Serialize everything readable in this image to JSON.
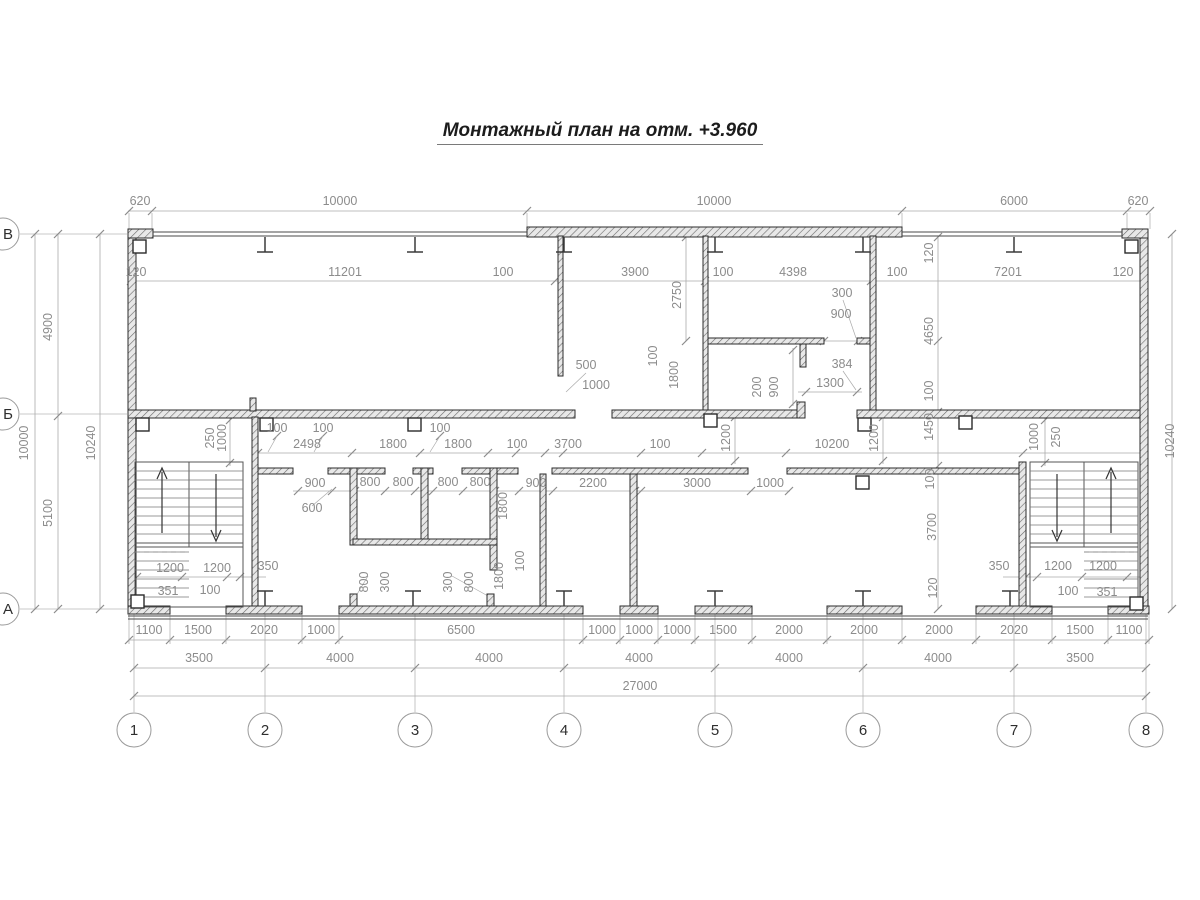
{
  "title": "Монтажный план на отм. +3.960",
  "colors": {
    "wall_line": "#2b2b2b",
    "dim_text": "#8c8c8c",
    "dim_line": "#aaaaaa",
    "grid_line": "#b8b8b8",
    "background": "#ffffff"
  },
  "axes": {
    "rows": [
      {
        "label": "В",
        "y": 234
      },
      {
        "label": "Б",
        "y": 414
      },
      {
        "label": "А",
        "y": 609
      }
    ],
    "cols": [
      {
        "label": "1",
        "x": 134
      },
      {
        "label": "2",
        "x": 265
      },
      {
        "label": "3",
        "x": 415
      },
      {
        "label": "4",
        "x": 564
      },
      {
        "label": "5",
        "x": 715
      },
      {
        "label": "6",
        "x": 863
      },
      {
        "label": "7",
        "x": 1014
      },
      {
        "label": "8",
        "x": 1146
      }
    ]
  },
  "dims": [
    {
      "t": "620",
      "x": 140,
      "y": 205
    },
    {
      "t": "10000",
      "x": 340,
      "y": 205
    },
    {
      "t": "10000",
      "x": 714,
      "y": 205
    },
    {
      "t": "6000",
      "x": 1014,
      "y": 205
    },
    {
      "t": "620",
      "x": 1138,
      "y": 205
    },
    {
      "t": "120",
      "x": 136,
      "y": 276
    },
    {
      "t": "11201",
      "x": 345,
      "y": 276
    },
    {
      "t": "100",
      "x": 503,
      "y": 276
    },
    {
      "t": "3900",
      "x": 635,
      "y": 276
    },
    {
      "t": "100",
      "x": 723,
      "y": 276
    },
    {
      "t": "4398",
      "x": 793,
      "y": 276
    },
    {
      "t": "100",
      "x": 897,
      "y": 276
    },
    {
      "t": "7201",
      "x": 1008,
      "y": 276
    },
    {
      "t": "120",
      "x": 1123,
      "y": 276
    },
    {
      "t": "4900",
      "x": 52,
      "y": 327,
      "r": -90
    },
    {
      "t": "5100",
      "x": 52,
      "y": 513,
      "r": -90
    },
    {
      "t": "10000",
      "x": 28,
      "y": 443,
      "r": -90
    },
    {
      "t": "10240",
      "x": 95,
      "y": 443,
      "r": -90
    },
    {
      "t": "10240",
      "x": 1174,
      "y": 441,
      "r": -90
    },
    {
      "t": "120",
      "x": 933,
      "y": 253,
      "r": -90
    },
    {
      "t": "4650",
      "x": 933,
      "y": 331,
      "r": -90
    },
    {
      "t": "100",
      "x": 933,
      "y": 391,
      "r": -90
    },
    {
      "t": "1450",
      "x": 933,
      "y": 427,
      "r": -90
    },
    {
      "t": "100",
      "x": 934,
      "y": 479,
      "r": -90
    },
    {
      "t": "3700",
      "x": 936,
      "y": 527,
      "r": -90
    },
    {
      "t": "120",
      "x": 937,
      "y": 588,
      "r": -90
    },
    {
      "t": "2750",
      "x": 681,
      "y": 295,
      "r": -90
    },
    {
      "t": "500",
      "x": 586,
      "y": 369
    },
    {
      "t": "1000",
      "x": 596,
      "y": 389
    },
    {
      "t": "100",
      "x": 657,
      "y": 356,
      "r": -90
    },
    {
      "t": "1800",
      "x": 678,
      "y": 375,
      "r": -90
    },
    {
      "t": "300",
      "x": 842,
      "y": 297
    },
    {
      "t": "900",
      "x": 841,
      "y": 318
    },
    {
      "t": "384",
      "x": 842,
      "y": 368
    },
    {
      "t": "1300",
      "x": 830,
      "y": 387
    },
    {
      "t": "200",
      "x": 761,
      "y": 387,
      "r": -90
    },
    {
      "t": "900",
      "x": 778,
      "y": 387,
      "r": -90
    },
    {
      "t": "100",
      "x": 277,
      "y": 432
    },
    {
      "t": "100",
      "x": 323,
      "y": 432
    },
    {
      "t": "100",
      "x": 440,
      "y": 432
    },
    {
      "t": "2498",
      "x": 307,
      "y": 448
    },
    {
      "t": "1800",
      "x": 393,
      "y": 448
    },
    {
      "t": "1800",
      "x": 458,
      "y": 448
    },
    {
      "t": "100",
      "x": 517,
      "y": 448
    },
    {
      "t": "3700",
      "x": 568,
      "y": 448
    },
    {
      "t": "100",
      "x": 660,
      "y": 448
    },
    {
      "t": "10200",
      "x": 832,
      "y": 448
    },
    {
      "t": "250",
      "x": 214,
      "y": 438,
      "r": -90
    },
    {
      "t": "1000",
      "x": 226,
      "y": 438,
      "r": -90
    },
    {
      "t": "1200",
      "x": 730,
      "y": 438,
      "r": -90
    },
    {
      "t": "1200",
      "x": 878,
      "y": 438,
      "r": -90
    },
    {
      "t": "1000",
      "x": 1038,
      "y": 437,
      "r": -90
    },
    {
      "t": "250",
      "x": 1060,
      "y": 437,
      "r": -90
    },
    {
      "t": "900",
      "x": 315,
      "y": 487
    },
    {
      "t": "800",
      "x": 370,
      "y": 486
    },
    {
      "t": "800",
      "x": 403,
      "y": 486
    },
    {
      "t": "800",
      "x": 448,
      "y": 486
    },
    {
      "t": "800",
      "x": 480,
      "y": 486
    },
    {
      "t": "900",
      "x": 536,
      "y": 487
    },
    {
      "t": "2200",
      "x": 593,
      "y": 487
    },
    {
      "t": "3000",
      "x": 697,
      "y": 487
    },
    {
      "t": "1000",
      "x": 770,
      "y": 487
    },
    {
      "t": "600",
      "x": 312,
      "y": 512
    },
    {
      "t": "1800",
      "x": 507,
      "y": 506,
      "r": -90
    },
    {
      "t": "1800",
      "x": 503,
      "y": 576,
      "r": -90
    },
    {
      "t": "100",
      "x": 524,
      "y": 561,
      "r": -90
    },
    {
      "t": "800",
      "x": 368,
      "y": 582,
      "r": -90
    },
    {
      "t": "300",
      "x": 389,
      "y": 582,
      "r": -90
    },
    {
      "t": "300",
      "x": 452,
      "y": 582,
      "r": -90
    },
    {
      "t": "800",
      "x": 473,
      "y": 582,
      "r": -90
    },
    {
      "t": "1200",
      "x": 170,
      "y": 572
    },
    {
      "t": "1200",
      "x": 217,
      "y": 572
    },
    {
      "t": "350",
      "x": 268,
      "y": 570
    },
    {
      "t": "351",
      "x": 168,
      "y": 595
    },
    {
      "t": "100",
      "x": 210,
      "y": 594
    },
    {
      "t": "350",
      "x": 999,
      "y": 570
    },
    {
      "t": "1200",
      "x": 1058,
      "y": 570
    },
    {
      "t": "1200",
      "x": 1103,
      "y": 570
    },
    {
      "t": "100",
      "x": 1068,
      "y": 595
    },
    {
      "t": "351",
      "x": 1107,
      "y": 596
    },
    {
      "t": "1100",
      "x": 149,
      "y": 634
    },
    {
      "t": "1500",
      "x": 198,
      "y": 634
    },
    {
      "t": "2020",
      "x": 264,
      "y": 634
    },
    {
      "t": "1000",
      "x": 321,
      "y": 634
    },
    {
      "t": "6500",
      "x": 461,
      "y": 634
    },
    {
      "t": "1000",
      "x": 602,
      "y": 634
    },
    {
      "t": "1000",
      "x": 639,
      "y": 634
    },
    {
      "t": "1000",
      "x": 677,
      "y": 634
    },
    {
      "t": "1500",
      "x": 723,
      "y": 634
    },
    {
      "t": "2000",
      "x": 789,
      "y": 634
    },
    {
      "t": "2000",
      "x": 864,
      "y": 634
    },
    {
      "t": "2000",
      "x": 939,
      "y": 634
    },
    {
      "t": "2020",
      "x": 1014,
      "y": 634
    },
    {
      "t": "1500",
      "x": 1080,
      "y": 634
    },
    {
      "t": "1100",
      "x": 1129,
      "y": 634
    },
    {
      "t": "3500",
      "x": 199,
      "y": 662
    },
    {
      "t": "4000",
      "x": 340,
      "y": 662
    },
    {
      "t": "4000",
      "x": 489,
      "y": 662
    },
    {
      "t": "4000",
      "x": 639,
      "y": 662
    },
    {
      "t": "4000",
      "x": 789,
      "y": 662
    },
    {
      "t": "4000",
      "x": 938,
      "y": 662
    },
    {
      "t": "3500",
      "x": 1080,
      "y": 662
    },
    {
      "t": "27000",
      "x": 640,
      "y": 690
    }
  ]
}
